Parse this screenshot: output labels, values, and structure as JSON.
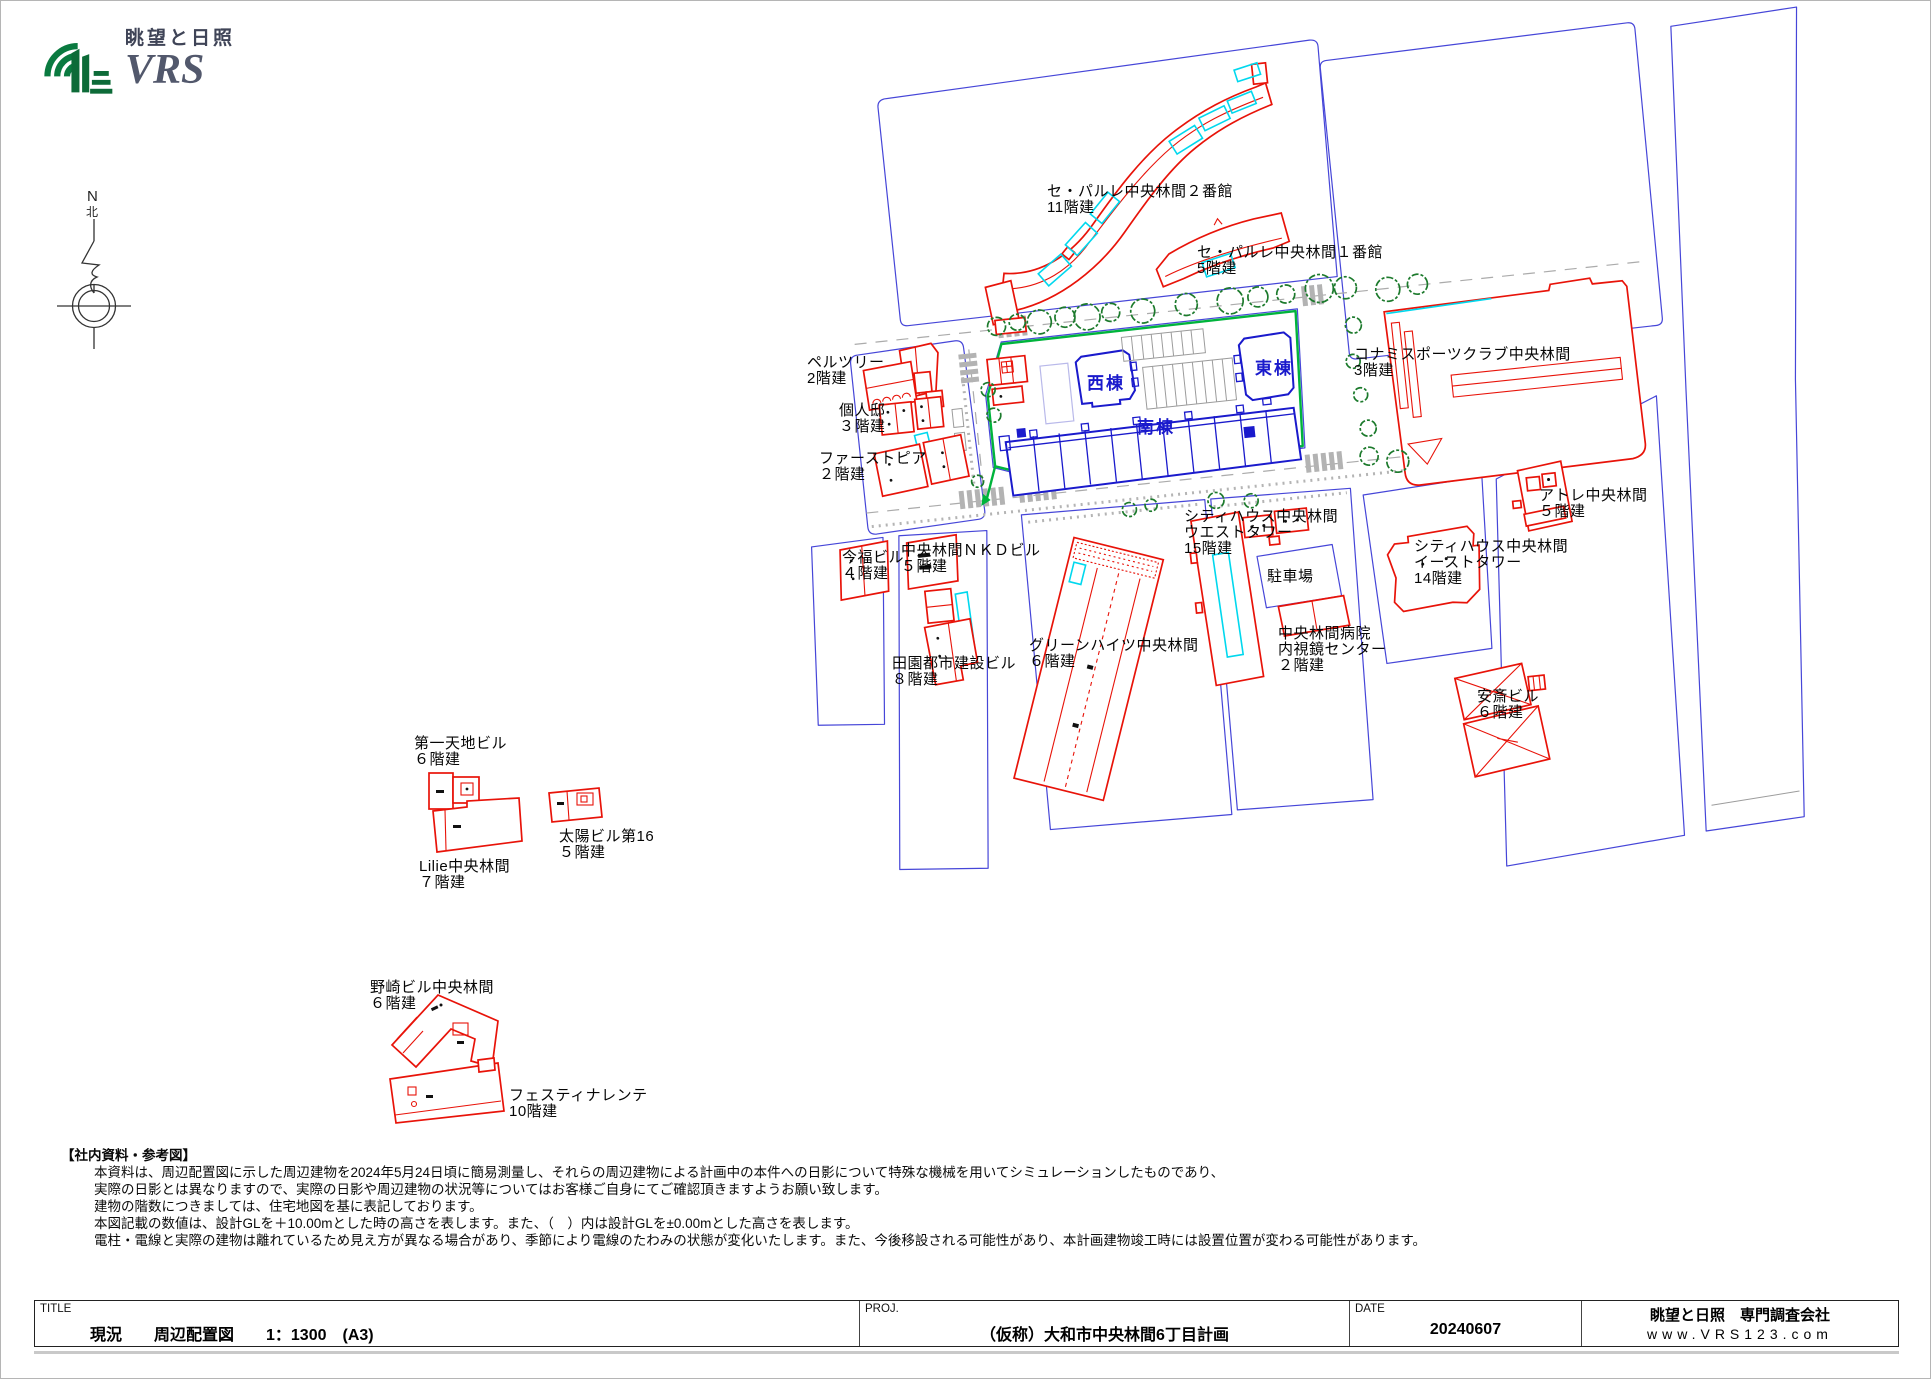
{
  "logo": {
    "brand_jp": "眺望と日照",
    "brand_en": "VRS"
  },
  "compass": {
    "n": "N",
    "kita": "北"
  },
  "colors": {
    "red": "#e81309",
    "lot-blue": "#4646d8",
    "subject-blue": "#1a1acc",
    "cyan": "#00d8ee",
    "site-green": "#00b43c",
    "tree-green": "#1c7a2c",
    "logo-green": "#0a7a40"
  },
  "map": {
    "labels": [
      {
        "id": "separle2",
        "name": "セ・パルレ中央林間２番館",
        "floors": "11階建",
        "x": 1046,
        "y": 195,
        "color": "black"
      },
      {
        "id": "separle1",
        "name": "セ・パルレ中央林間１番館",
        "floors": "5階建",
        "x": 1196,
        "y": 256,
        "color": "black"
      },
      {
        "id": "konami",
        "name": "コナミスポーツクラブ中央林間",
        "floors": "3階建",
        "x": 1353,
        "y": 358,
        "color": "black"
      },
      {
        "id": "pelztree",
        "name": "ペルツリー",
        "floors": "2階建",
        "x": 806,
        "y": 366,
        "color": "black"
      },
      {
        "id": "kojintei",
        "name": "個人邸",
        "floors": "３階建",
        "x": 838,
        "y": 414,
        "color": "black"
      },
      {
        "id": "firstpia",
        "name": "ファーストピア",
        "floors": "２階建",
        "x": 818,
        "y": 462,
        "color": "black"
      },
      {
        "id": "imafuku",
        "name": "今福ビル",
        "floors": "４階建",
        "x": 841,
        "y": 561,
        "color": "black"
      },
      {
        "id": "nkd",
        "name": "中央林間ＮＫＤビル",
        "floors": "５階建",
        "x": 900,
        "y": 554,
        "color": "black"
      },
      {
        "id": "denen",
        "name": "田園都市建設ビル",
        "floors": "８階建",
        "x": 891,
        "y": 667,
        "color": "black"
      },
      {
        "id": "greenheights",
        "name": "グリーンハイツ中央林間",
        "floors": "６階建",
        "x": 1028,
        "y": 649,
        "color": "black"
      },
      {
        "id": "cityhouse-west",
        "name": "シティハウス中央林間",
        "floors": "ウエストタワー|15階建",
        "x": 1183,
        "y": 520,
        "color": "black"
      },
      {
        "id": "parking",
        "name": "駐車場",
        "floors": "",
        "x": 1266,
        "y": 580,
        "color": "black"
      },
      {
        "id": "hospital",
        "name": "中央林間病院",
        "floors": "内視鏡センター|２階建",
        "x": 1277,
        "y": 637,
        "color": "black"
      },
      {
        "id": "cityhouse-east",
        "name": "シティハウス中央林間",
        "floors": "イーストタワー|14階建",
        "x": 1413,
        "y": 550,
        "color": "black"
      },
      {
        "id": "atre",
        "name": "アトレ中央林間",
        "floors": "５階建",
        "x": 1538,
        "y": 499,
        "color": "black"
      },
      {
        "id": "anzai",
        "name": "安斎ビル",
        "floors": "６階建",
        "x": 1476,
        "y": 700,
        "color": "black"
      },
      {
        "id": "daiichitenchi",
        "name": "第一天地ビル",
        "floors": "６階建",
        "x": 413,
        "y": 747,
        "color": "black"
      },
      {
        "id": "taiyo",
        "name": "太陽ビル第16",
        "floors": "５階建",
        "x": 558,
        "y": 840,
        "color": "black"
      },
      {
        "id": "lilie",
        "name": "Lilie中央林間",
        "floors": "７階建",
        "x": 418,
        "y": 870,
        "color": "black"
      },
      {
        "id": "nozaki",
        "name": "野崎ビル中央林間",
        "floors": "６階建",
        "x": 369,
        "y": 991,
        "color": "black"
      },
      {
        "id": "festina",
        "name": "フェスティナレンテ",
        "floors": "10階建",
        "x": 508,
        "y": 1099,
        "color": "black"
      },
      {
        "id": "west-wing",
        "name": "西棟",
        "floors": "",
        "x": 1086,
        "y": 388,
        "color": "blue"
      },
      {
        "id": "east-wing",
        "name": "東棟",
        "floors": "",
        "x": 1254,
        "y": 373,
        "color": "blue"
      },
      {
        "id": "south-wing",
        "name": "南棟",
        "floors": "",
        "x": 1136,
        "y": 432,
        "color": "blue"
      }
    ]
  },
  "notes": {
    "header": "【社内資料・参考図】",
    "lines": [
      "本資料は、周辺配置図に示した周辺建物を2024年5月24日頃に簡易測量し、それらの周辺建物による計画中の本件への日影について特殊な機械を用いてシミュレーションしたものであり、",
      "実際の日影とは異なりますので、実際の日影や周辺建物の状況等についてはお客様ご自身にてご確認頂きますようお願い致します。",
      "建物の階数につきましては、住宅地図を基に表記しております。",
      "本図記載の数値は、設計GLを＋10.00mとした時の高さを表します。また、（　）内は設計GLを±0.00mとした高さを表します。",
      "電柱・電線と実際の建物は離れているため見え方が異なる場合があり、季節により電線のたわみの状態が変化いたします。また、今後移設される可能性があり、本計画建物竣工時には設置位置が変わる可能性があります。"
    ]
  },
  "titlebar": {
    "title_label": "TITLE",
    "title_value": "現況　　周辺配置図　　1：1300　(A3)",
    "proj_label": "PROJ.",
    "proj_value": "（仮称）大和市中央林間6丁目計画",
    "date_label": "DATE",
    "date_value": "20240607",
    "company": "眺望と日照　専門調査会社",
    "website": "www.VRS123.com"
  }
}
